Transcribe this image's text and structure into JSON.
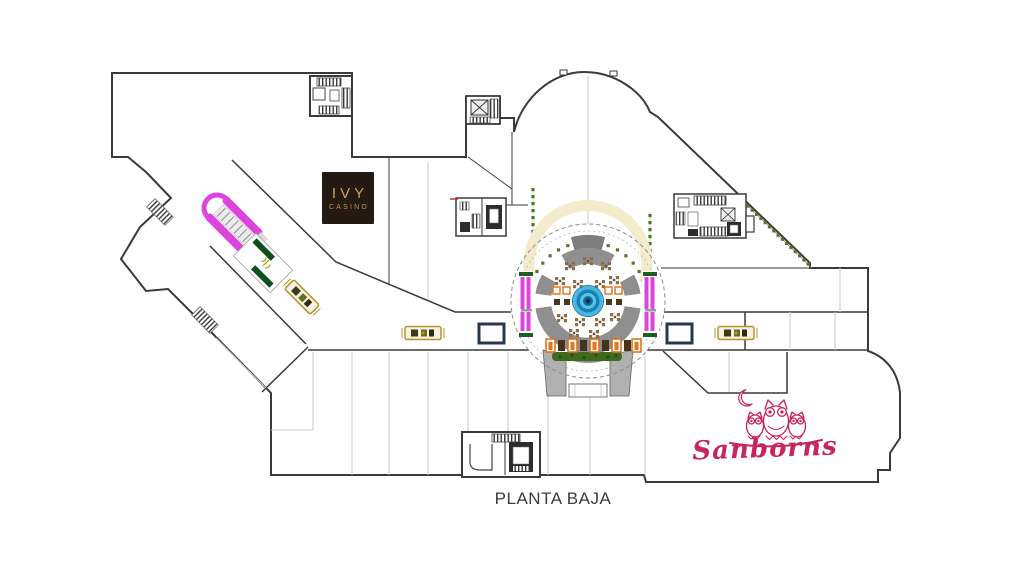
{
  "title": {
    "floor_label": "PLANTA BAJA"
  },
  "stores": {
    "ivy": {
      "line1": "IVY",
      "line2": "CASINO"
    },
    "sanborns": {
      "name": "Sanborns"
    }
  },
  "colors": {
    "walls": "#3a3a3a",
    "partitions": "#c9c9c9",
    "escalator_magenta": "#dd44dd",
    "elevator_green": "#0d4f1c",
    "fountain_blue": "#2fa8d8",
    "planter_green": "#3f6a1e",
    "awning_cream": "#f4eacc",
    "bench_gold": "#b8912a",
    "kiosk_navy": "#24394e",
    "tree_green": "#5c7026",
    "seating_orange": "#e07820",
    "table_brown": "#8a6f48",
    "ivy_sign_bg": "#241a12",
    "ivy_sign_gold": "#c9a35b",
    "sanborns_pink": "#c8255a"
  },
  "icons": {
    "fountain-icon": "concentric blue circles",
    "escalator-icon": "parallel magenta bars with loop",
    "elevator-icon": "box with X",
    "stairs-icon": "hatched band",
    "bench-icon": "gold outlined rectangle with dark seats",
    "kiosk-icon": "navy outlined rectangle",
    "tree-row-icon": "line of green dots",
    "owl-logo-icon": "three owls on a branch",
    "crescent-moon-icon": "crescent moon outline"
  }
}
